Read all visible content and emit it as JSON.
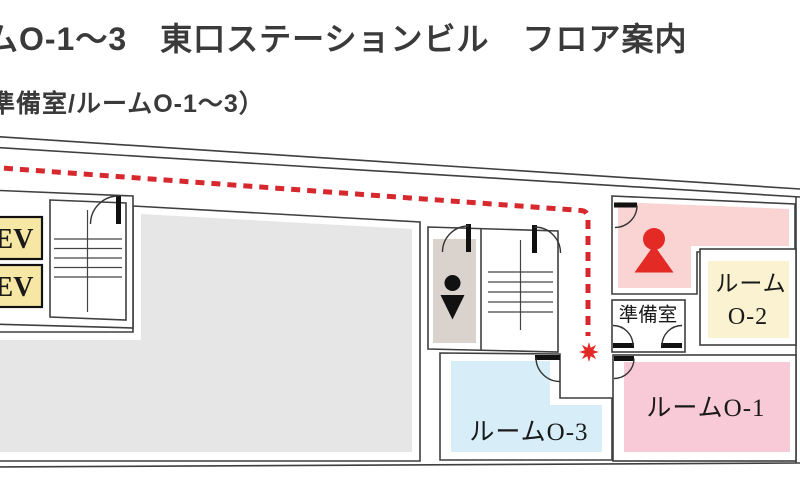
{
  "header": {
    "title": "ムO-1～3　東口ステーションビル　フロア案内",
    "subtitle": "準備室/ルームO-1～3）"
  },
  "floor_plan": {
    "rooms": {
      "room_o1": {
        "label": "ルームO-1",
        "fill": "#f8c9d6"
      },
      "room_o2": {
        "label_line1": "ルーム",
        "label_line2": "O-2",
        "fill": "#fbf2d2"
      },
      "room_o3": {
        "label": "ルームO-3",
        "fill": "#d7eef9"
      },
      "prep_room": {
        "label": "準備室",
        "fill": "#ffffff"
      },
      "elevator_1": {
        "label": "EV",
        "fill": "#f6e7a4"
      },
      "elevator_2": {
        "label": "EV",
        "fill": "#f6e7a4"
      },
      "staffed_room": {
        "fill": "#fad3d3"
      },
      "restroom": {
        "fill": "#d9d2cd"
      },
      "closed_area": {
        "fill": "#e6e6e6"
      }
    },
    "icons": {
      "restroom_person": "person-silhouette-icon",
      "staff_person": "red-person-marker-icon",
      "destination": "red-burst-star-icon"
    },
    "route": {
      "color": "#d7282d",
      "style": "dashed"
    }
  },
  "colors": {
    "wall": "#3f3f3f",
    "door": "#111111",
    "red": "#e32a24",
    "title_text": "#3a3a3a",
    "label_text": "#1a1a1a"
  }
}
